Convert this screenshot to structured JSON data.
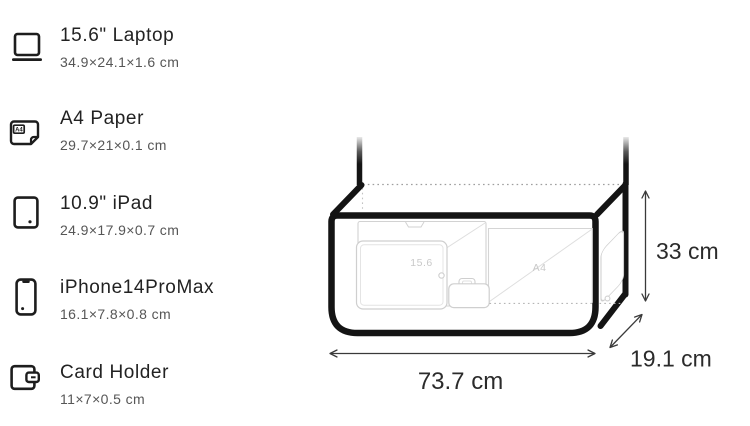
{
  "sidebar": {
    "items": [
      {
        "label": "15.6\" Laptop",
        "dimensions": "34.9×24.1×1.6 cm",
        "icon": "laptop-icon"
      },
      {
        "label": "A4 Paper",
        "dimensions": "29.7×21×0.1 cm",
        "icon": "a4-paper-icon",
        "icon_text": "A4"
      },
      {
        "label": "10.9\" iPad",
        "dimensions": "24.9×17.9×0.7 cm",
        "icon": "tablet-icon"
      },
      {
        "label": "iPhone14ProMax",
        "dimensions": "16.1×7.8×0.8 cm",
        "icon": "phone-icon"
      },
      {
        "label": "Card Holder",
        "dimensions": "11×7×0.5 cm",
        "icon": "wallet-icon"
      }
    ]
  },
  "diagram": {
    "type": "bag-size-comparison",
    "width": {
      "value": 73.7,
      "unit": "cm",
      "label": "73.7 cm"
    },
    "height": {
      "value": 33,
      "unit": "cm",
      "label": "33 cm"
    },
    "depth": {
      "value": 19.1,
      "unit": "cm",
      "label": "19.1 cm"
    },
    "inside_labels": {
      "laptop": "15.6",
      "a4_paper": "A4"
    },
    "colors": {
      "outline": "#141414",
      "faint_item": "#cfcfcf",
      "dimension_line": "#3a3a3a",
      "dimension_text": "#2b2b2b",
      "dotted_edge": "#9e9e9e"
    }
  }
}
